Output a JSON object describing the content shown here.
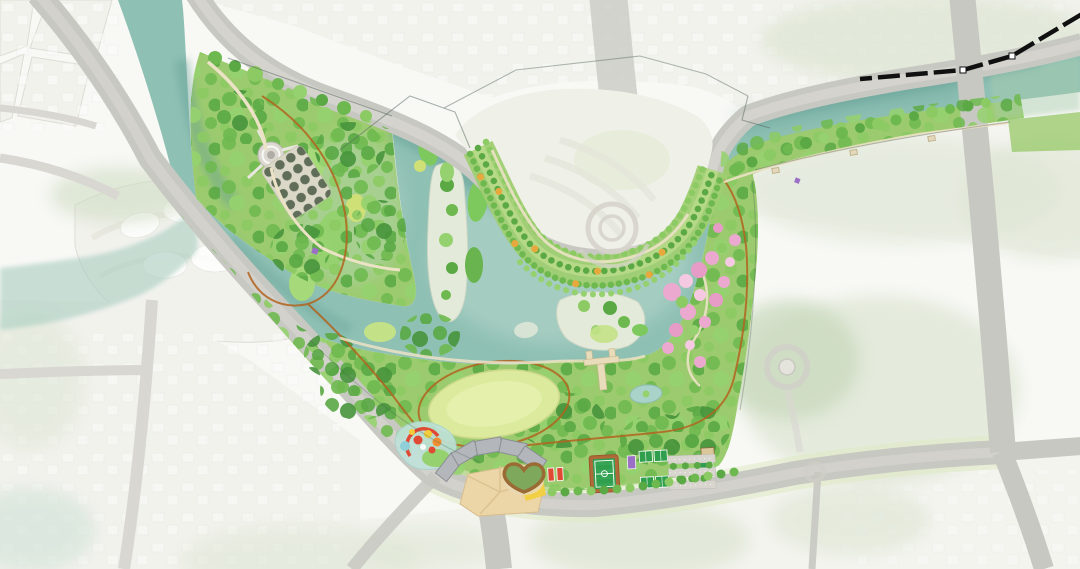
{
  "scene": {
    "kind": "landscape-masterplan-site-plan",
    "features": [
      "river",
      "central-lake",
      "tributary-wash",
      "wetland-islands",
      "sand-islands",
      "nw-park",
      "lower-park",
      "ne-riverbank-strip",
      "orchard-terrace-bank",
      "cherry-blossom-grove",
      "great-lawn",
      "amphitheater",
      "children-playground",
      "heart-garden",
      "sports-field",
      "ball-courts",
      "parking-lot",
      "boat-pier",
      "circular-plaza",
      "orchard-grid",
      "jogging-trail",
      "riverside-promenade",
      "top-riverside-road",
      "south-artery-road",
      "river-bridge-road",
      "inner-access-road",
      "roundabout",
      "site-boundary-dashed-line",
      "survey-lines",
      "urban-context-blocks",
      "street-tree-row",
      "pond"
    ]
  },
  "palette": {
    "paper": "#f8f8f5",
    "urban_block": "#f2f2ed",
    "urban_block_tint": "#eff1e8",
    "urban_line": "#dddcd4",
    "building_white": "#ffffff",
    "sage": "#dce5d2",
    "sage_deep": "#cbdabf",
    "sage_teal": "#cfe2d6",
    "park_base": "#9ccb6f",
    "canopy_a": "#6eb94f",
    "canopy_b": "#8cca63",
    "canopy_c": "#5aa945",
    "canopy_d": "#95d16e",
    "canopy_dark": "#47953c",
    "meadow": "#c3e287",
    "meadow_bright": "#a6d97a",
    "marsh_yellow": "#cfe077",
    "water": "#8fc0b4",
    "water_dark": "#639f94",
    "water_light": "#bad8cd",
    "water_green_tint": "#a9cdae",
    "tributary": "#a9cec0",
    "wetland": "#7ec95e",
    "wetland_dark": "#69b44e",
    "island_sand": "#e3ead9",
    "road": "#c8c8c2",
    "road_light": "#d8d7d2",
    "road_verge": "#dfe9c2",
    "trail": "#b2641f",
    "path": "#ece2c6",
    "lawn": "#dcea9e",
    "lawn_light": "#e6f1ae",
    "plaza": "#ecd6a8",
    "plaza_line": "#d9bd8c",
    "roof": "#b3b7bb",
    "field_green": "#2f9e4d",
    "field_stripe": "#3cab5b",
    "track": "#b06a3a",
    "court_purple": "#9a6fc5",
    "blossom": "#eba9d0",
    "blossom_light": "#f4c9e1",
    "blossom_deep": "#e79cc8",
    "accent_orange": "#e7a83d",
    "play_red": "#e04a34",
    "play_yellow": "#f2cf3a",
    "pool": "#bfe2da",
    "pool_blue": "#8fd0d8",
    "pier": "#e9dcba",
    "building_tan": "#dcc79a",
    "grid_tree": "#5f6d59",
    "grid_bg": "#dbd8c7",
    "boundary": "#111111",
    "survey": "#54655d",
    "pond": "#a9d3c9",
    "heart_fill": "#7ea85c",
    "heart_rim": "#9a6b35"
  }
}
